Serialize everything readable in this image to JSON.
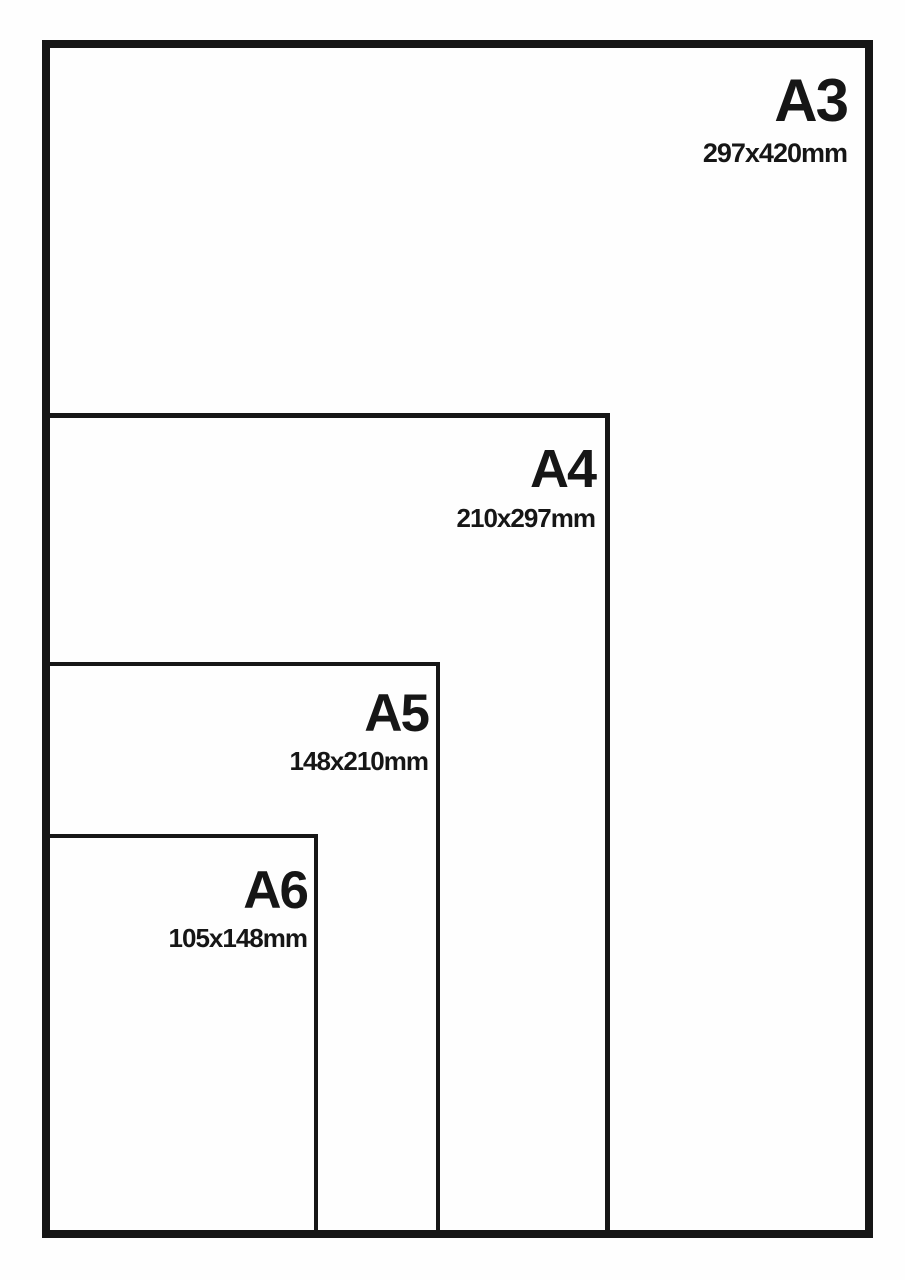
{
  "colors": {
    "ink": "#161616",
    "background": "#fefefe"
  },
  "sizes": [
    {
      "name": "A3",
      "dimensions": "297x420mm"
    },
    {
      "name": "A4",
      "dimensions": "210x297mm"
    },
    {
      "name": "A5",
      "dimensions": "148x210mm"
    },
    {
      "name": "A6",
      "dimensions": "105x148mm"
    }
  ]
}
